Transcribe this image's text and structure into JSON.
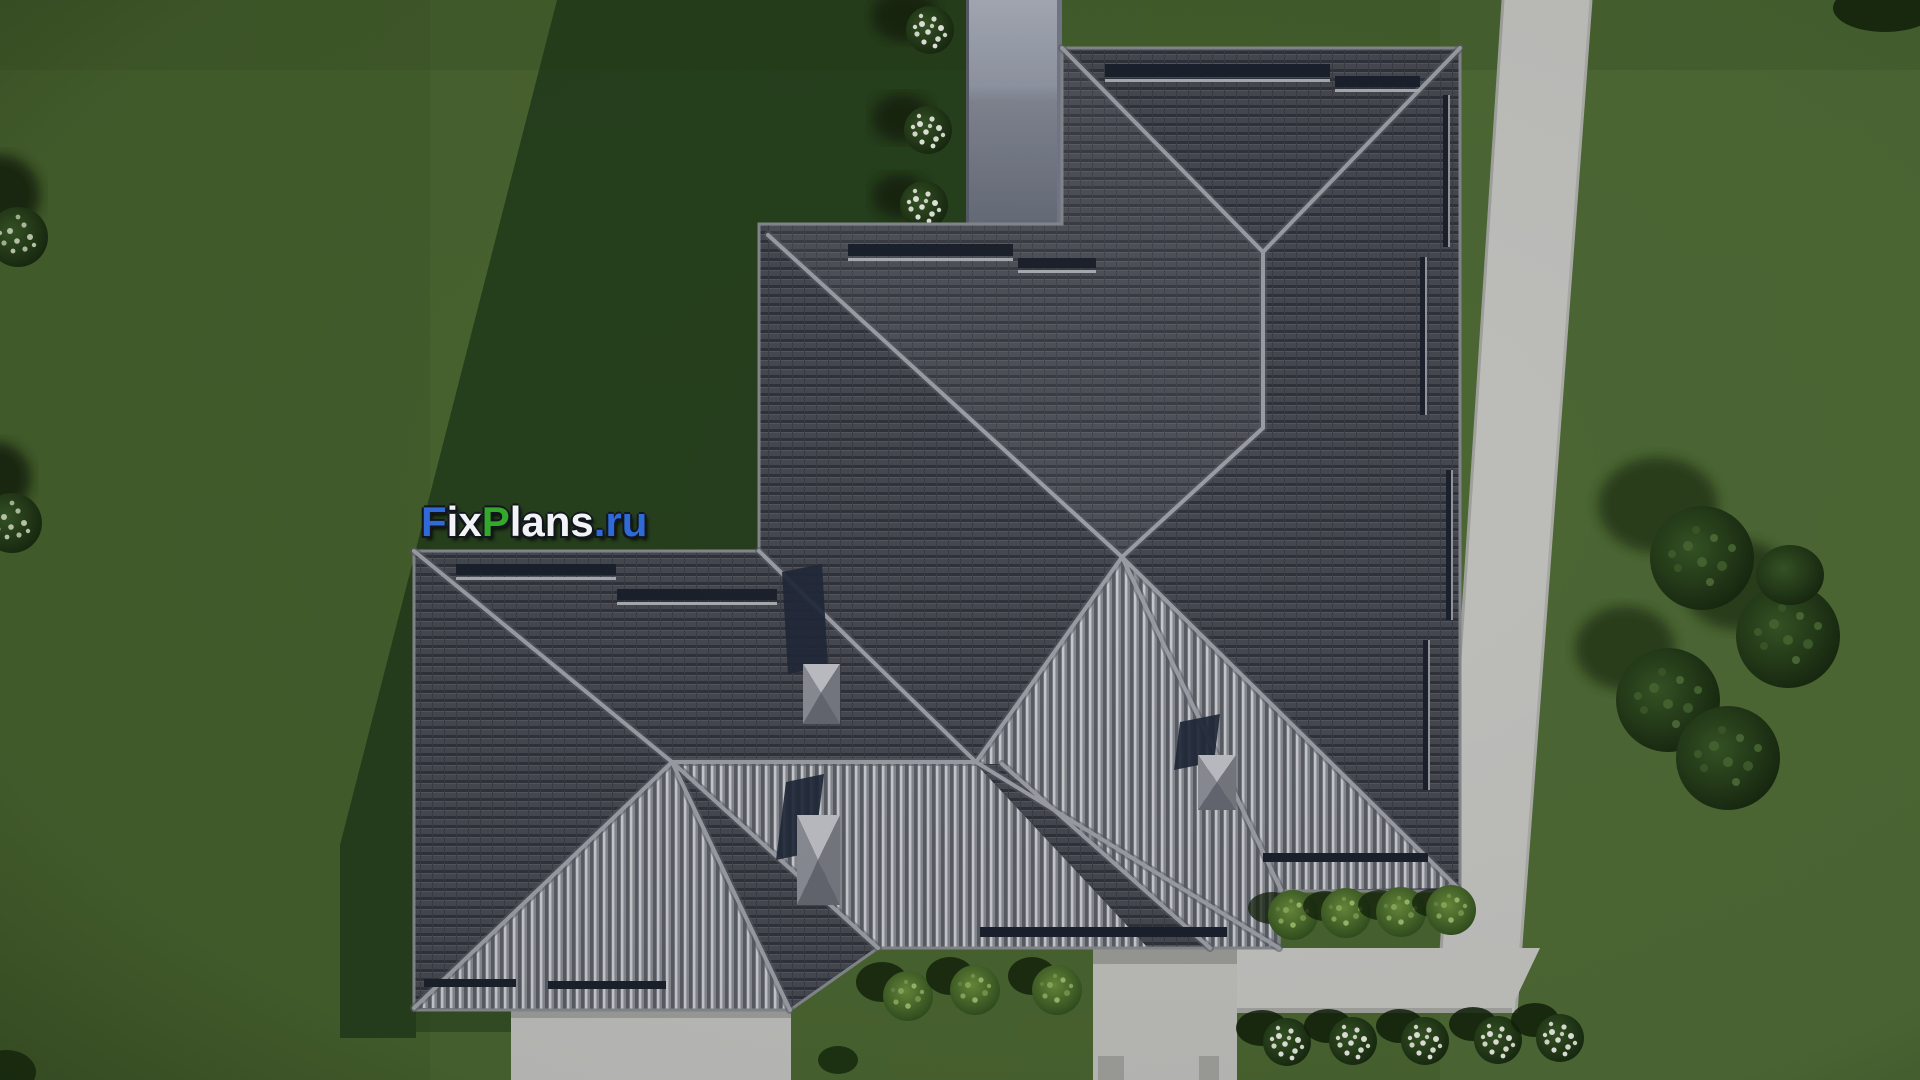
{
  "watermark": {
    "text": "FixPlans.ru",
    "segments": [
      {
        "text": "F",
        "color": "#2f6ad6"
      },
      {
        "text": "ix",
        "color": "#f2f3f5"
      },
      {
        "text": "P",
        "color": "#33a82a"
      },
      {
        "text": "lans",
        "color": "#f2f3f5"
      },
      {
        "text": ".ru",
        "color": "#2f6ad6"
      }
    ]
  },
  "palette": {
    "grass": "#4e6a33",
    "grass_light": "#587540",
    "grass_dark": "#46622d",
    "cast_shadow": "#26401e",
    "walkway": "#cfcfcc",
    "walkway_edge": "#aeaeab",
    "roof_dark_tile": "#4b4e56",
    "roof_bright_rib": "#d6d9dd",
    "ridge": "#a6a9af",
    "chimney_wall_top": "#b3b8c4",
    "chimney_wall_bottom": "#6d7380",
    "snow_guard": "#1e2430",
    "foliage_dark": "#16270f",
    "foliage_light": "#76a152",
    "flowers": "#f4f6ee"
  },
  "scene": {
    "type": "aerial-architectural-render",
    "subject": "hip roof plan top view of a single family house",
    "counts": {
      "flower_bushes_top": 3,
      "flower_bushes_bottom_row": 5,
      "green_bushes_center": 3,
      "green_bushes_right_eave": 4,
      "pale_bushes_left_edge": 2,
      "shrub_clusters_right": 1,
      "chimneys": 3,
      "walkways": 4
    }
  }
}
